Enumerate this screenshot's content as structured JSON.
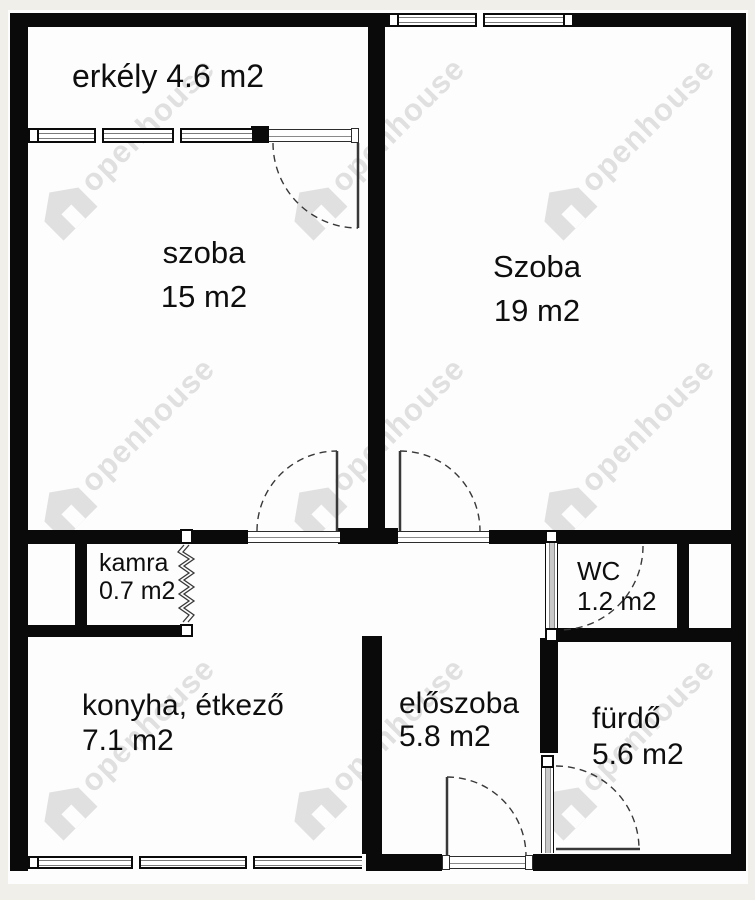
{
  "watermark": {
    "text": "openhouse"
  },
  "rooms": {
    "erkely": {
      "name": "erkély",
      "area": "4.6 m2"
    },
    "szoba15": {
      "name": "szoba",
      "area": "15 m2"
    },
    "szoba19": {
      "name": "Szoba",
      "area": "19 m2"
    },
    "kamra": {
      "name": "kamra",
      "area": "0.7 m2"
    },
    "wc": {
      "name": "WC",
      "area": "1.2 m2"
    },
    "konyha": {
      "name": "konyha, étkező",
      "area": "7.1 m2"
    },
    "eloszoba": {
      "name": "előszoba",
      "area": "5.8 m2"
    },
    "furdo": {
      "name": "fürdő",
      "area": "5.6 m2"
    }
  }
}
